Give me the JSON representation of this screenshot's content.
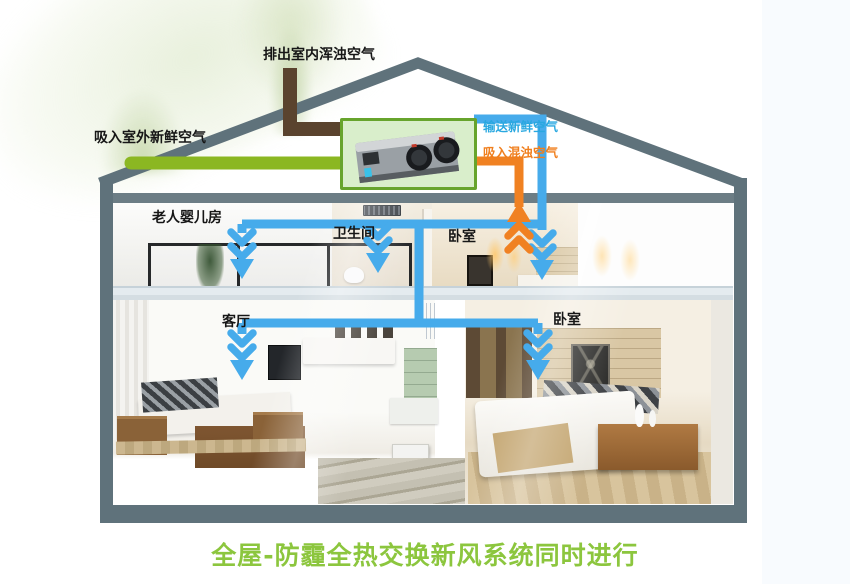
{
  "title": "全屋-防霾全热交换新风系统同时进行",
  "labels": {
    "exhaust_air": "排出室内浑浊空气",
    "fresh_air_intake": "吸入室外新鲜空气",
    "supply_fresh_air": "输送新鲜空气",
    "return_dirty_air": "吸入混浊空气"
  },
  "rooms": {
    "elderly_baby_room": "老人婴儿房",
    "bathroom": "卫生间",
    "bedroom_upper": "卧室",
    "living_room": "客厅",
    "bedroom_lower": "卧室"
  },
  "airflow": {
    "supply_arrow_count": 5,
    "return_arrow_count": 1,
    "supply_direction": "down",
    "return_direction": "up"
  },
  "icons": {
    "hrv_unit": "gray-box-with-two-fans",
    "airflow_down": "stacked-chevrons-down",
    "airflow_up": "stacked-chevrons-up",
    "smoke_plume": "soft-green-plume"
  },
  "colors": {
    "frame": "#5f727b",
    "pipe_fresh": "#8bb722",
    "pipe_exhaust": "#5a432e",
    "pipe_supply": "#46abeb",
    "pipe_return": "#f08122",
    "label_supply": "#29a8e0",
    "label_return": "#f07f1e",
    "title": "#8cc63e",
    "hrv_border": "#67a42c",
    "hrv_bg": "#d9eecb"
  }
}
